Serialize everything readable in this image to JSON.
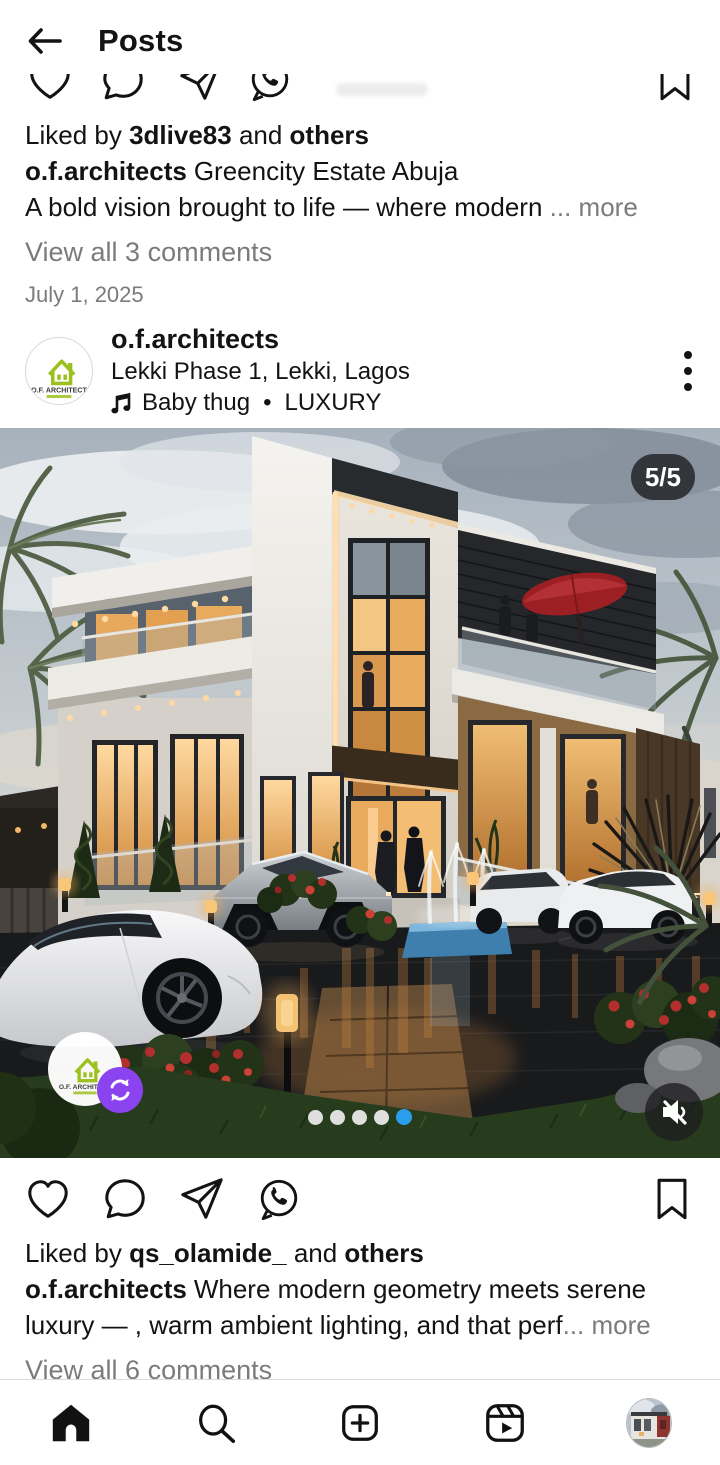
{
  "header": {
    "title": "Posts"
  },
  "prev_post": {
    "liked_by_prefix": "Liked by ",
    "liked_by_user": "3dlive83",
    "liked_by_and": " and ",
    "liked_by_others": "others",
    "username": "o.f.architects",
    "caption_title": "Greencity Estate Abuja",
    "caption_body": "A bold vision brought to life — where modern",
    "ellipsis": " ...",
    "more_label": " more",
    "view_comments": "View all 3 comments",
    "date": "July 1, 2025"
  },
  "main_post": {
    "username": "o.f.architects",
    "location": "Lekki Phase 1, Lekki, Lagos",
    "music_track": "Baby thug",
    "music_separator": "•",
    "music_artist": "LUXURY",
    "carousel": {
      "badge": "5/5",
      "total_slides": 5,
      "current_slide": 5,
      "dot_count": 5,
      "active_dot": 5
    },
    "image_description": "Dusk render of a modern three-storey white and charcoal villa with warm lit glass, palm trees, fountains, a red balcony umbrella, luxury cars (white sports car, Cybertruck, white SUVs) on a wet reflective driveway with red flowering bushes",
    "liked_by_prefix": "Liked by ",
    "liked_by_user": "qs_olamide_",
    "liked_by_and": " and ",
    "liked_by_others": "others",
    "caption_body": "Where modern geometry meets serene luxury — , warm ambient lighting, and that perf",
    "ellipsis": "...",
    "more_label": " more",
    "view_comments": "View all 6 comments"
  },
  "logo": {
    "text": "O.F. ARCHITECT"
  },
  "icons": {
    "back": "arrow-left",
    "like": "heart-outline",
    "comment": "speech-bubble",
    "share": "paper-plane",
    "whatsapp": "whatsapp-logo",
    "save": "bookmark",
    "more_options": "kebab-vertical",
    "music": "music-note",
    "mute": "speaker-muted",
    "repost": "repost-arrows",
    "nav": [
      "home",
      "search",
      "create-plus",
      "reels",
      "profile-avatar"
    ]
  },
  "colors": {
    "accent_blue": "#2aa3f7",
    "text_primary": "#131313",
    "text_secondary": "#7b7b7b",
    "badge_bg": "rgba(33,34,37,0.84)",
    "repost_purple": "#8a43ee",
    "logo_green": "#9cc11f",
    "nav_border": "#dbdbdb"
  }
}
